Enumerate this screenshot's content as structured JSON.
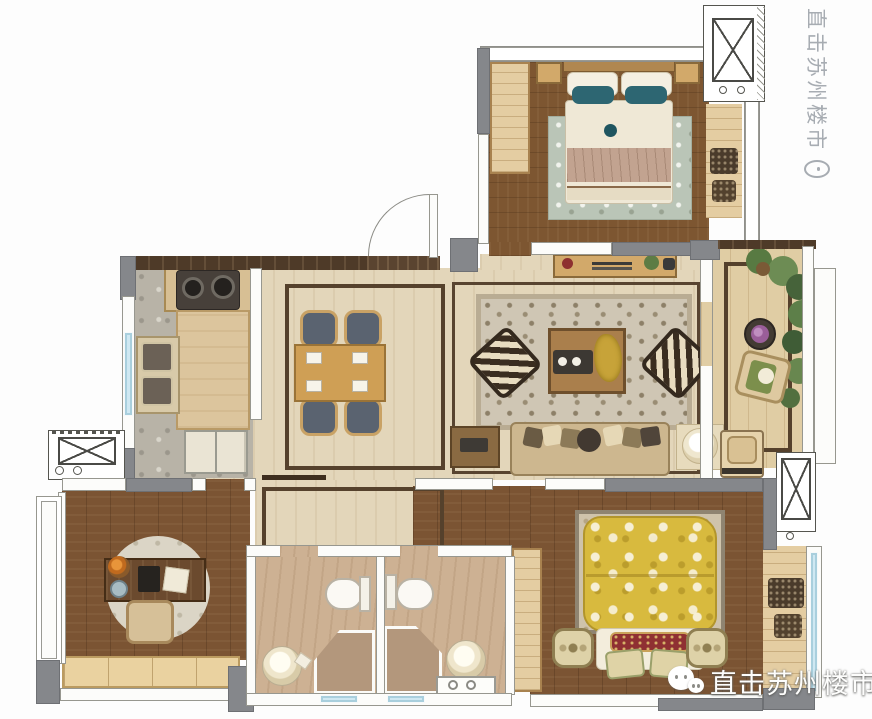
{
  "watermarks": {
    "vertical": {
      "text": "直击苏州楼市",
      "logo": "person-doodle-logo"
    },
    "bottom": {
      "text": "直击苏州楼市",
      "logo": "wechat-chat-bubbles-logo"
    }
  },
  "palette": {
    "wall_gray": "#85878b",
    "wall_white": "#fcfcfa",
    "wood_dark_floor": "#7b5433",
    "wood_light": "#e4cda2",
    "floor_beige": "#e3d6ba",
    "kitchen_stone": "#b8b3a7",
    "bath_floor": "#cdb193",
    "shower_floor": "#b3977c",
    "window_glass": "#cfe8f2",
    "inlay_brown": "#55412c",
    "rug_living": "#cfc6b4",
    "rug_bedroom_top": "#bac5b7",
    "accent_teal_pillow": "#2d6672",
    "accent_yellow_duvet": "#d8ba3e",
    "accent_red_pillow": "#8f3032",
    "plant_green": "#5d7f49",
    "watermark_gray": "#a7acb2",
    "watermark_white": "#ffffff"
  },
  "symbols": {
    "shaft": "box-with-x-cross",
    "door": "quarter-arc-swing",
    "window": "double-line-glass-band"
  },
  "rooms": [
    {
      "name": "bedroom-top",
      "furniture": [
        "double-bed",
        "teal-pillows",
        "wardrobe",
        "nightstands",
        "rug",
        "window-bench"
      ]
    },
    {
      "name": "living-room",
      "furniture": [
        "sofa",
        "coffee-table",
        "accent-chairs",
        "tv-console",
        "patterned-rug",
        "side-tables"
      ]
    },
    {
      "name": "dining-room",
      "furniture": [
        "dining-table",
        "four-chairs",
        "floor-inlay"
      ]
    },
    {
      "name": "kitchen",
      "furniture": [
        "stove",
        "double-sink",
        "counter",
        "cabinet"
      ]
    },
    {
      "name": "study",
      "furniture": [
        "desk",
        "chair",
        "round-rug",
        "low-bench"
      ]
    },
    {
      "name": "bathroom-a",
      "furniture": [
        "toilet",
        "round-basin",
        "corner-shower"
      ]
    },
    {
      "name": "bathroom-b",
      "furniture": [
        "toilet",
        "round-basin",
        "corner-shower",
        "vanity"
      ]
    },
    {
      "name": "master-bedroom",
      "furniture": [
        "yellow-floral-bed",
        "red-pillow",
        "nightstands",
        "wardrobe",
        "rug"
      ]
    },
    {
      "name": "balcony-right",
      "furniture": [
        "lounge-chair",
        "flower-pot",
        "plants",
        "washing-machine"
      ]
    },
    {
      "name": "balcony-master",
      "furniture": [
        "cushions"
      ]
    }
  ]
}
